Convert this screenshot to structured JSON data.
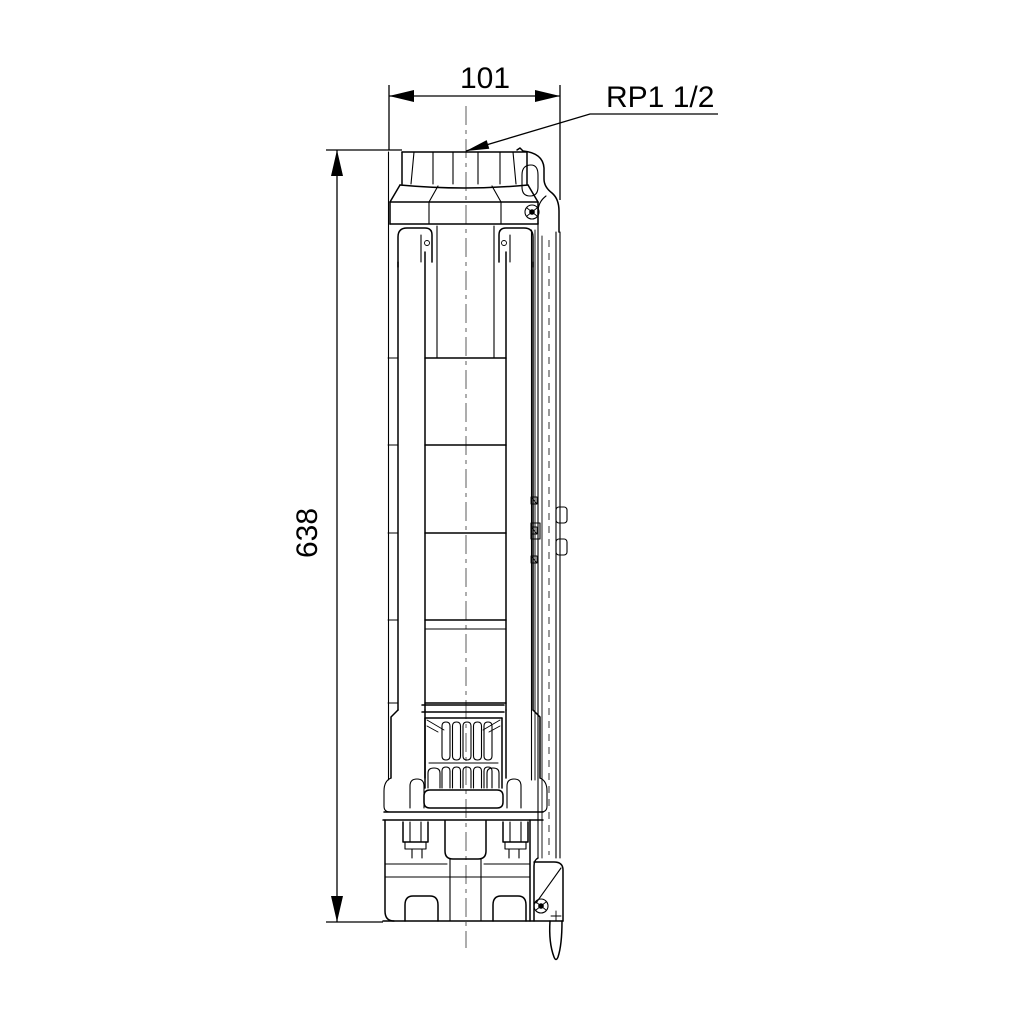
{
  "drawing": {
    "dimension_width_label": "101",
    "dimension_height_label": "638",
    "connection_label": "RP1 1/2"
  },
  "icons": {
    "centerline": "dash-dot vertical center line",
    "dimension_arrows": "filled triangular arrowheads"
  },
  "colors": {
    "line": "#000000",
    "centerline": "#8a8a8a",
    "background": "#ffffff"
  }
}
